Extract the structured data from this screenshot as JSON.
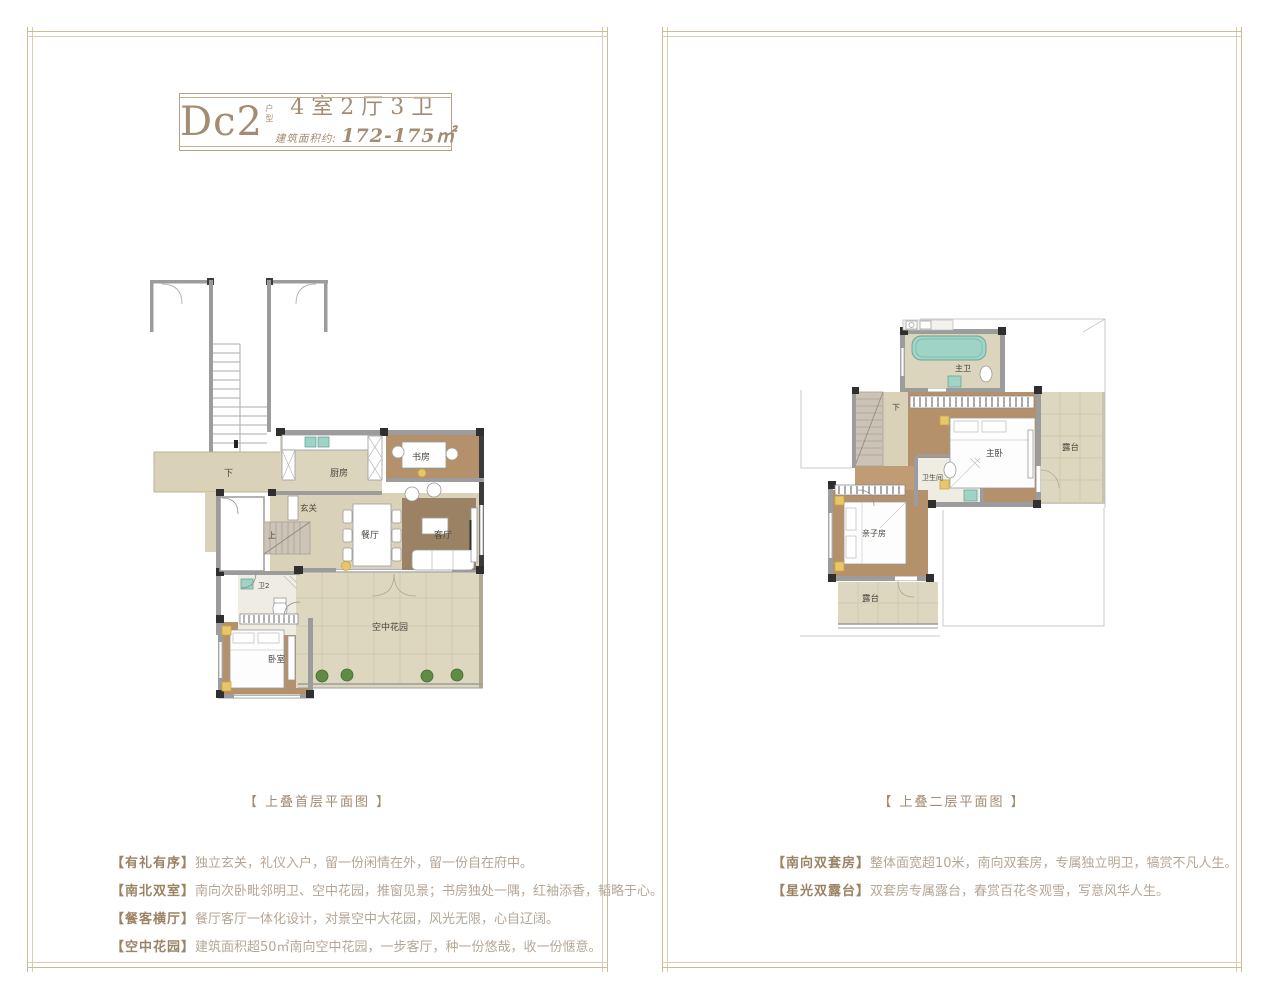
{
  "colors": {
    "frame_outer": "#c9bc97",
    "frame_inner": "#d8cdb2",
    "title_brown": "#a38c72",
    "feature_label": "#9b8365",
    "feature_text": "#b5a697",
    "wall_dark": "#3b3b3b",
    "wall_gray": "#9c9c9c",
    "floor_beige": "#d9d2b8",
    "floor_wood": "#b5916b",
    "terrace": "#ddd7c0",
    "fixture_teal": "#9ed3c6",
    "plant_green": "#5f8c45",
    "accent_yellow": "#e8c76a"
  },
  "left_panel": {
    "title": {
      "code": "Dc2",
      "code_suffix": "户型",
      "rooms": "4室2厅3卫",
      "area_label": "建筑面积约: ",
      "area_value": "172-175㎡"
    },
    "caption": "【 上叠首层平面图 】",
    "features": [
      {
        "label": "【有礼有序】",
        "text": "独立玄关，礼仪入户，留一份闲情在外，留一份自在府中。"
      },
      {
        "label": "【南北双室】",
        "text": "南向次卧毗邻明卫、空中花园，推窗见景；书房独处一隅，红袖添香，韬略于心。"
      },
      {
        "label": "【餐客横厅】",
        "text": "餐厅客厅一体化设计，对景空中大花园，风光无限，心自辽阔。"
      },
      {
        "label": "【空中花园】",
        "text": "建筑面积超50㎡南向空中花园，一步客厅，种一份悠哉，收一份惬意。"
      }
    ],
    "plan_labels": {
      "down": "下",
      "kitchen": "厨房",
      "study": "书房",
      "foyer": "玄关",
      "up": "上",
      "dining": "餐厅",
      "living": "客厅",
      "bath2": "卫2",
      "bedroom": "卧室",
      "sky_garden": "空中花园"
    }
  },
  "right_panel": {
    "caption": "【 上叠二层平面图 】",
    "features": [
      {
        "label": "【南向双套房】",
        "text": "整体面宽超10米，南向双套房，专属独立明卫，犒赏不凡人生。"
      },
      {
        "label": "【星光双露台】",
        "text": "双套房专属露台，春赏百花冬观雪，写意风华人生。"
      }
    ],
    "plan_labels": {
      "master_bath": "主卫",
      "master_bed": "主卧",
      "terrace_right": "露台",
      "down": "下",
      "bath": "卫生间",
      "kids_room": "亲子房",
      "terrace_bottom": "露台"
    }
  }
}
